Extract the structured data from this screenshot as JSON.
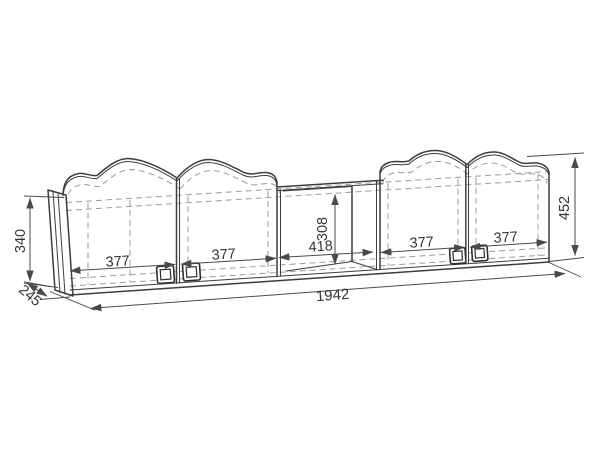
{
  "colors": {
    "background": "#ffffff",
    "outline": "#3d3d3d",
    "dimension_lines": "#4a4a4a",
    "hidden_lines": "#9b9b9b",
    "text": "#333333"
  },
  "dimensions": {
    "door1_width": "377",
    "door2_width": "377",
    "opening_width": "418",
    "opening_height": "308",
    "door3_width": "377",
    "door4_width": "377",
    "total_width": "1942",
    "left_height": "340",
    "depth": "245",
    "right_height": "452"
  }
}
